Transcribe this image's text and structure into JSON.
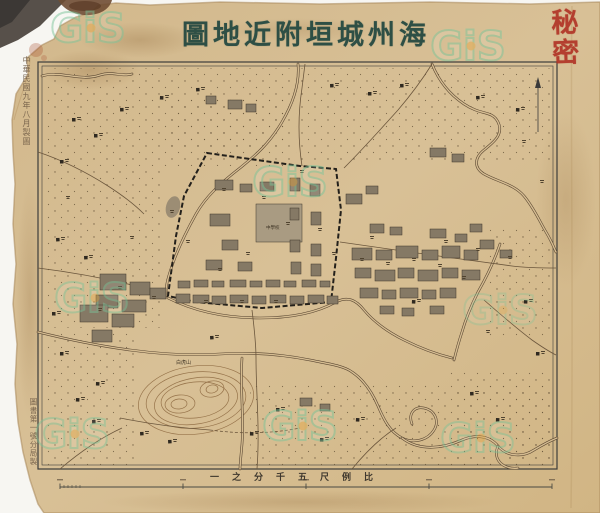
{
  "title": {
    "display": "圖地近附垣城州海",
    "reading": "海州城垣附近地圖"
  },
  "seal": {
    "text": "秘密",
    "color": "#b13527"
  },
  "annotations": {
    "left_top": "中華民國九年八月製圖",
    "left_bottom": "圖書第一號分局製"
  },
  "scale": {
    "caption_display": "一之分千五尺例比",
    "caption_reading": "比例尺五千分之一",
    "bar": {
      "x1": 60,
      "x2": 552,
      "y": 487,
      "major": [
        60,
        183,
        306,
        429,
        552
      ],
      "minor": [
        64,
        68,
        72,
        76,
        80
      ]
    }
  },
  "watermarks": {
    "text": "GiS",
    "color": "#7cc59b",
    "dot_color": "#e8a33c",
    "positions": [
      [
        88,
        42,
        0.5
      ],
      [
        468,
        60,
        0.5
      ],
      [
        290,
        196,
        0.5
      ],
      [
        92,
        312,
        0.45
      ],
      [
        300,
        440,
        0.5
      ],
      [
        72,
        448,
        0.45
      ],
      [
        478,
        452,
        0.45
      ],
      [
        500,
        324,
        0.3
      ]
    ]
  },
  "palette": {
    "paper": "#d6bd92",
    "paper_dark": "#c2a273",
    "river_edge": "#5a4732",
    "road": "#6b563c",
    "wall": "#23201b",
    "building": "#857965",
    "building_light": "#a99b82",
    "building_edge": "#3e362a",
    "hamlet": "#2f2920",
    "mark": "#50432f",
    "contour": "#96734a",
    "pond": "#9c8d74",
    "stipple": "#6a573c",
    "frame": "#3d3d3b"
  },
  "map": {
    "labels": {
      "hill": "白虎山",
      "school": "中學校"
    },
    "frame": {
      "x": 38,
      "y": 62,
      "w": 519,
      "h": 407
    },
    "north_arrow": {
      "x": 538,
      "y1": 84,
      "y2": 132
    },
    "wall_path": "M207,153 L300,166 L336,169 L341,210 L336,258 L331,302 L262,308 L196,302 L168,296 L176,236 L184,196 Z",
    "rivers": [
      "M42,76 C60,70 80,82 100,75 C112,71 122,77 132,74",
      "M298,64 C300,85 292,105 282,122 C268,146 252,158 240,168 C222,182 206,196 196,214 C186,232 176,252 170,272 C166,284 166,290 166,296",
      "M432,64 C440,84 452,96 464,104 C482,116 492,110 498,122 C504,134 494,142 484,150 C474,158 474,168 484,174 C498,182 514,184 524,196 C534,208 540,222 546,232 C552,242 554,248 556,252",
      "M500,244 C494,262 486,278 478,292 C472,304 466,318 462,332 C458,344 456,352 454,360",
      "M38,332 C70,340 100,346 130,350 C160,354 190,356 220,354 C250,352 280,354 310,360 C330,364 344,366 352,372 C364,380 372,392 378,406 C384,420 390,432 402,438 C414,444 428,440 434,430 C440,420 434,410 424,408 C414,406 408,414 412,424",
      "M402,438 C420,452 444,448 462,440 C476,434 490,436 498,446 C506,456 522,458 534,450 C544,444 552,440 557,438",
      "M498,446 C492,460 504,470 518,468",
      "M168,298 C196,312 228,318 260,318 C292,318 318,312 336,302 C348,296 356,300 364,310 C374,322 388,332 404,340 C420,348 436,354 452,358",
      "M242,358 C240,388 244,418 242,444 C241,456 240,464 240,469"
    ],
    "roads": [
      {
        "d": "M38,268 C70,272 104,278 136,286 C148,289 158,292 166,294"
      },
      {
        "d": "M252,310 C254,326 256,342 256,358 C256,394 260,428 257,469"
      },
      {
        "d": "M340,242 C368,246 396,250 424,254 C452,258 484,262 512,266 C528,268 544,268 556,268"
      },
      {
        "d": "M484,300 C500,314 516,328 532,340 C542,347 550,352 556,355"
      },
      {
        "d": "M344,168 C362,150 380,130 398,110 C410,96 422,80 432,64"
      },
      {
        "d": "M302,166 C298,140 298,114 302,88 C303,80 304,72 305,64"
      },
      {
        "d": "M38,152 C62,160 86,172 108,186 C122,195 134,204 144,214"
      },
      {
        "d": "M60,469 C80,452 100,438 122,428"
      },
      {
        "d": "M352,469 C366,452 380,438 396,428"
      },
      {
        "d": "M120,418 C150,424 180,428 210,430"
      },
      {
        "d": "M210,430 C240,434 270,434 300,428",
        "dashed": true
      }
    ],
    "stipple_patches": [
      [
        44,
        68,
        246,
        98
      ],
      [
        296,
        68,
        256,
        96
      ],
      [
        44,
        168,
        118,
        160
      ],
      [
        44,
        330,
        92,
        136
      ],
      [
        488,
        228,
        64,
        112
      ],
      [
        250,
        382,
        196,
        84
      ],
      [
        448,
        368,
        104,
        98
      ],
      [
        168,
        96,
        120,
        52
      ],
      [
        455,
        386,
        97,
        80
      ]
    ],
    "contours": [
      [
        196,
        400,
        58,
        34,
        -8
      ],
      [
        196,
        400,
        50,
        28,
        -6
      ],
      [
        196,
        401,
        42,
        23,
        -10
      ],
      [
        195,
        400,
        34,
        18,
        -6
      ],
      [
        180,
        404,
        15,
        9,
        -5
      ],
      [
        179,
        404,
        8,
        5,
        -5
      ],
      [
        212,
        389,
        12,
        8,
        -10
      ],
      [
        212,
        389,
        6,
        4,
        -10
      ]
    ],
    "pond": [
      173,
      207,
      7,
      11,
      15
    ],
    "buildings": [
      [
        256,
        204,
        46,
        38,
        "light"
      ],
      [
        215,
        180,
        18,
        10
      ],
      [
        240,
        184,
        12,
        8
      ],
      [
        260,
        182,
        14,
        9
      ],
      [
        210,
        214,
        20,
        12
      ],
      [
        222,
        240,
        16,
        10
      ],
      [
        206,
        260,
        16,
        10
      ],
      [
        238,
        262,
        14,
        9
      ],
      [
        290,
        178,
        10,
        13
      ],
      [
        310,
        184,
        10,
        12
      ],
      [
        290,
        208,
        9,
        12
      ],
      [
        311,
        212,
        10,
        13
      ],
      [
        290,
        240,
        10,
        12
      ],
      [
        311,
        244,
        10,
        12
      ],
      [
        291,
        262,
        10,
        12
      ],
      [
        311,
        264,
        10,
        12
      ],
      [
        178,
        281,
        12,
        7
      ],
      [
        194,
        280,
        14,
        7
      ],
      [
        212,
        281,
        12,
        6
      ],
      [
        230,
        280,
        16,
        7
      ],
      [
        250,
        281,
        12,
        6
      ],
      [
        266,
        280,
        14,
        7
      ],
      [
        284,
        281,
        12,
        6
      ],
      [
        302,
        280,
        14,
        7
      ],
      [
        320,
        281,
        10,
        6
      ],
      [
        176,
        294,
        14,
        9
      ],
      [
        193,
        295,
        16,
        8
      ],
      [
        212,
        296,
        14,
        8
      ],
      [
        230,
        295,
        18,
        8
      ],
      [
        252,
        296,
        14,
        8
      ],
      [
        270,
        295,
        16,
        8
      ],
      [
        290,
        296,
        14,
        8
      ],
      [
        308,
        295,
        16,
        8
      ],
      [
        327,
        296,
        11,
        8
      ],
      [
        100,
        274,
        26,
        16
      ],
      [
        130,
        282,
        20,
        13
      ],
      [
        96,
        295,
        22,
        13
      ],
      [
        122,
        300,
        24,
        12
      ],
      [
        150,
        288,
        16,
        11
      ],
      [
        80,
        305,
        28,
        17
      ],
      [
        112,
        314,
        22,
        13
      ],
      [
        92,
        330,
        20,
        12
      ],
      [
        352,
        248,
        20,
        12
      ],
      [
        376,
        250,
        16,
        10
      ],
      [
        396,
        246,
        22,
        12
      ],
      [
        422,
        250,
        16,
        10
      ],
      [
        442,
        246,
        18,
        12
      ],
      [
        464,
        250,
        14,
        10
      ],
      [
        355,
        268,
        16,
        10
      ],
      [
        375,
        270,
        20,
        11
      ],
      [
        398,
        268,
        16,
        10
      ],
      [
        418,
        270,
        20,
        11
      ],
      [
        442,
        268,
        16,
        10
      ],
      [
        462,
        270,
        18,
        10
      ],
      [
        360,
        288,
        18,
        10
      ],
      [
        382,
        290,
        14,
        9
      ],
      [
        400,
        288,
        18,
        10
      ],
      [
        422,
        290,
        14,
        9
      ],
      [
        440,
        288,
        16,
        10
      ],
      [
        370,
        224,
        14,
        9
      ],
      [
        390,
        227,
        12,
        8
      ],
      [
        430,
        229,
        16,
        9
      ],
      [
        455,
        234,
        12,
        8
      ],
      [
        480,
        240,
        14,
        9
      ],
      [
        500,
        250,
        12,
        8
      ],
      [
        470,
        224,
        12,
        8
      ],
      [
        380,
        306,
        14,
        8
      ],
      [
        402,
        308,
        12,
        8
      ],
      [
        430,
        306,
        14,
        8
      ],
      [
        346,
        194,
        16,
        10
      ],
      [
        366,
        186,
        12,
        8
      ],
      [
        430,
        148,
        16,
        9
      ],
      [
        452,
        154,
        12,
        8
      ],
      [
        228,
        100,
        14,
        9
      ],
      [
        246,
        104,
        10,
        8
      ],
      [
        206,
        96,
        10,
        8
      ],
      [
        300,
        398,
        12,
        8
      ],
      [
        320,
        404,
        10,
        7
      ]
    ],
    "hamlets": [
      [
        72,
        118
      ],
      [
        94,
        134
      ],
      [
        60,
        160
      ],
      [
        120,
        108
      ],
      [
        160,
        96
      ],
      [
        196,
        88
      ],
      [
        330,
        84
      ],
      [
        368,
        92
      ],
      [
        400,
        84
      ],
      [
        476,
        96
      ],
      [
        516,
        108
      ],
      [
        56,
        238
      ],
      [
        84,
        256
      ],
      [
        52,
        312
      ],
      [
        60,
        352
      ],
      [
        96,
        382
      ],
      [
        76,
        398
      ],
      [
        92,
        420
      ],
      [
        140,
        432
      ],
      [
        168,
        440
      ],
      [
        250,
        432
      ],
      [
        276,
        408
      ],
      [
        356,
        418
      ],
      [
        412,
        300
      ],
      [
        524,
        300
      ],
      [
        536,
        352
      ],
      [
        470,
        392
      ],
      [
        496,
        418
      ],
      [
        320,
        438
      ],
      [
        210,
        336
      ]
    ],
    "label_marks": [
      [
        222,
        188
      ],
      [
        262,
        196
      ],
      [
        286,
        222
      ],
      [
        246,
        252
      ],
      [
        218,
        268
      ],
      [
        318,
        228
      ],
      [
        332,
        252
      ],
      [
        360,
        258
      ],
      [
        386,
        262
      ],
      [
        412,
        258
      ],
      [
        438,
        264
      ],
      [
        462,
        276
      ],
      [
        300,
        170
      ],
      [
        274,
        300
      ],
      [
        240,
        300
      ],
      [
        204,
        300
      ],
      [
        370,
        236
      ],
      [
        444,
        240
      ],
      [
        476,
        248
      ],
      [
        508,
        256
      ],
      [
        152,
        296
      ],
      [
        118,
        286
      ],
      [
        98,
        308
      ],
      [
        170,
        210
      ],
      [
        186,
        240
      ],
      [
        522,
        140
      ],
      [
        540,
        180
      ],
      [
        66,
        196
      ],
      [
        130,
        236
      ],
      [
        486,
        330
      ]
    ]
  }
}
